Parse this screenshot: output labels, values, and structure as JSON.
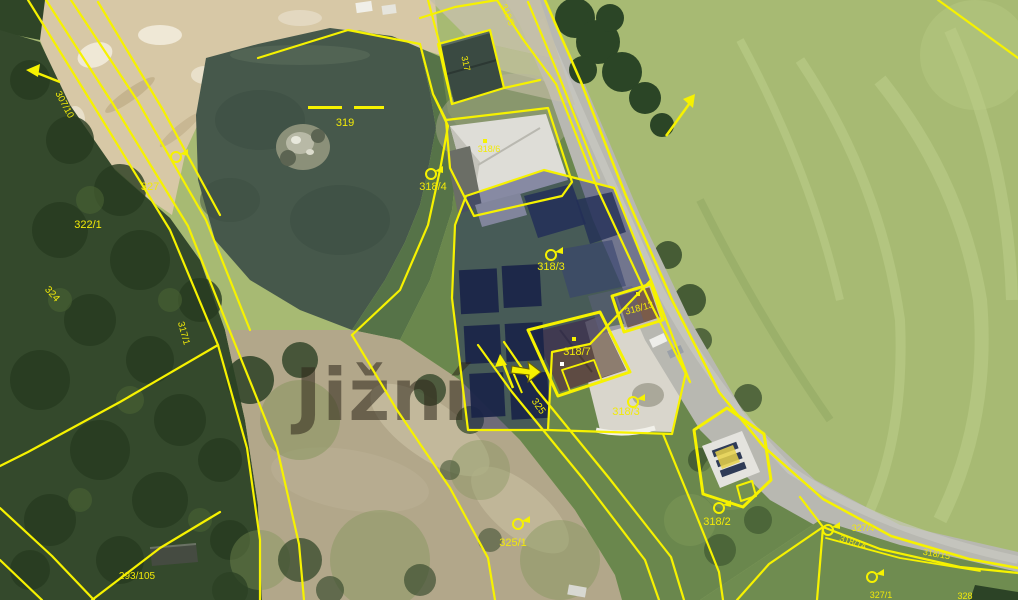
{
  "map": {
    "kind": "cadastral-parcel-overlay-on-aerial-photo",
    "watermark_text": "Jižní",
    "highlighted_parcel": "318/3",
    "colors": {
      "parcel_line": "#f6f200",
      "parcel_label": "#f2ea08",
      "selection_fill": "rgba(28,38,100,0.45)",
      "selected_building_fill": "#1a2448",
      "water": "#46584b",
      "field": "#a7ba73",
      "forest": "#34492c",
      "sand": "#d7c8a6",
      "road": "#b8b8b1",
      "dirt": "#b2a78a",
      "watermark": "rgba(46,38,26,0.55)"
    },
    "parcel_labels": [
      {
        "id": "319",
        "text": "319",
        "x": 345,
        "y": 126,
        "rotate": 0,
        "size": 11
      },
      {
        "id": "327",
        "text": "327",
        "x": 150,
        "y": 190,
        "rotate": 0,
        "size": 11
      },
      {
        "id": "322-1",
        "text": "322/1",
        "x": 88,
        "y": 228,
        "rotate": 0,
        "size": 11
      },
      {
        "id": "307-10",
        "text": "307/10",
        "x": 62,
        "y": 106,
        "rotate": 62,
        "size": 9.5
      },
      {
        "id": "324",
        "text": "324",
        "x": 50,
        "y": 296,
        "rotate": 48,
        "size": 10
      },
      {
        "id": "317-1",
        "text": "317/1",
        "x": 181,
        "y": 334,
        "rotate": 75,
        "size": 9.5
      },
      {
        "id": "318-4",
        "text": "318/4",
        "x": 433,
        "y": 190,
        "rotate": 0,
        "size": 11
      },
      {
        "id": "318-6",
        "text": "318/6",
        "x": 489,
        "y": 152,
        "rotate": 0,
        "size": 9
      },
      {
        "id": "317",
        "text": "317",
        "x": 463,
        "y": 64,
        "rotate": 78,
        "size": 9
      },
      {
        "id": "310-5",
        "text": "310/5",
        "x": 505,
        "y": 16,
        "rotate": 68,
        "size": 9
      },
      {
        "id": "318-3-selected",
        "text": "318/3",
        "x": 551,
        "y": 270,
        "rotate": 0,
        "size": 11
      },
      {
        "id": "318-13",
        "text": "318/13",
        "x": 640,
        "y": 311,
        "rotate": -15,
        "size": 9.5
      },
      {
        "id": "318-7",
        "text": "318/7",
        "x": 577,
        "y": 355,
        "rotate": 0,
        "size": 11
      },
      {
        "id": "318-3-garden",
        "text": "318/3",
        "x": 626,
        "y": 415,
        "rotate": 0,
        "size": 11
      },
      {
        "id": "325-road",
        "text": "325",
        "x": 536,
        "y": 408,
        "rotate": 55,
        "size": 10
      },
      {
        "id": "325-1",
        "text": "325/1",
        "x": 513,
        "y": 546,
        "rotate": 0,
        "size": 11
      },
      {
        "id": "318-2",
        "text": "318/2",
        "x": 717,
        "y": 525,
        "rotate": 0,
        "size": 11
      },
      {
        "id": "293-105",
        "text": "293/105",
        "x": 137,
        "y": 579,
        "rotate": 0,
        "size": 10
      },
      {
        "id": "327-4",
        "text": "327/4",
        "x": 863,
        "y": 531,
        "rotate": 0,
        "size": 9
      },
      {
        "id": "318-14",
        "text": "318/14",
        "x": 852,
        "y": 545,
        "rotate": 18,
        "size": 9
      },
      {
        "id": "318-15",
        "text": "318/15",
        "x": 936,
        "y": 557,
        "rotate": 10,
        "size": 9
      },
      {
        "id": "327-1",
        "text": "327/1",
        "x": 881,
        "y": 598,
        "rotate": 0,
        "size": 9
      },
      {
        "id": "328",
        "text": "328",
        "x": 965,
        "y": 599,
        "rotate": 0,
        "size": 9
      }
    ],
    "boundary_marker_symbols": [
      {
        "x": 176,
        "y": 157
      },
      {
        "x": 431,
        "y": 174
      },
      {
        "x": 551,
        "y": 255
      },
      {
        "x": 633,
        "y": 402
      },
      {
        "x": 719,
        "y": 508
      },
      {
        "x": 518,
        "y": 524
      },
      {
        "x": 828,
        "y": 530
      },
      {
        "x": 872,
        "y": 577
      }
    ],
    "building_point_symbols": [
      {
        "x": 485,
        "y": 141
      },
      {
        "x": 574,
        "y": 339
      },
      {
        "x": 638,
        "y": 294
      }
    ],
    "water_parcel_dash_symbol": {
      "parcel": "319",
      "y": 108,
      "segments": [
        [
          308,
          342
        ],
        [
          354,
          384
        ]
      ]
    }
  }
}
